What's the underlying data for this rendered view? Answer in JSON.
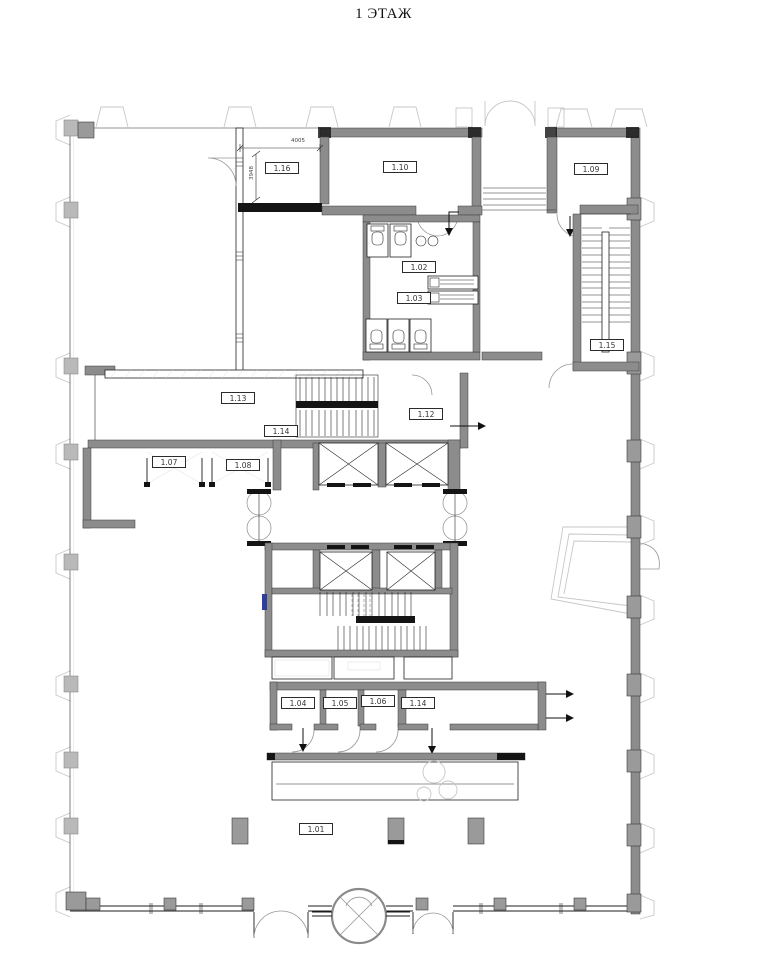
{
  "title": "1 ЭТАЖ",
  "rooms": [
    {
      "number": "1.16"
    },
    {
      "number": "1.10"
    },
    {
      "number": "1.09"
    },
    {
      "number": "1.02"
    },
    {
      "number": "1.03"
    },
    {
      "number": "1.15"
    },
    {
      "number": "1.13"
    },
    {
      "number": "1.14"
    },
    {
      "number": "1.12"
    },
    {
      "number": "1.07"
    },
    {
      "number": "1.08"
    },
    {
      "number": "1.04"
    },
    {
      "number": "1.05"
    },
    {
      "number": "1.06"
    },
    {
      "number": "1.14"
    },
    {
      "number": "1.01"
    }
  ],
  "dimensions": [
    {
      "text": "4005"
    },
    {
      "text": "3948"
    }
  ],
  "colors": {
    "background": "#ffffff",
    "wall_gray": "#8c8c8c",
    "line_black": "#1c1c1c",
    "column_gray": "#9a9a9a",
    "faded_gray": "#c7c7c7",
    "accent_blue": "#2e3f9e"
  }
}
